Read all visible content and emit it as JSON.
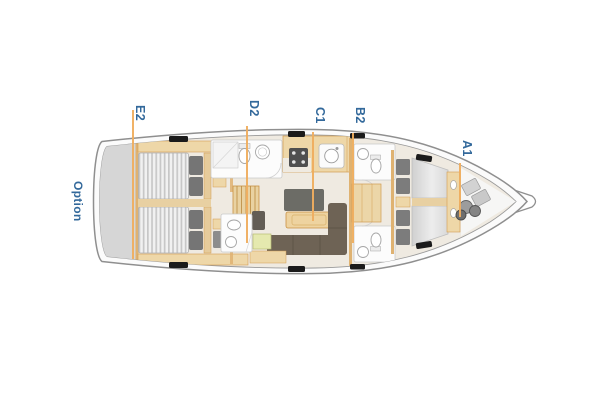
{
  "diagram": {
    "type": "yacht-interior-layout-plan",
    "orientation": "bow-right",
    "annotations": {
      "option": "Option",
      "labels": [
        {
          "code": "E2",
          "area": "aft-cabins"
        },
        {
          "code": "D2",
          "area": "aft-head-galley"
        },
        {
          "code": "C1",
          "area": "salon"
        },
        {
          "code": "B2",
          "area": "forward-heads"
        },
        {
          "code": "A1",
          "area": "forward-cabin"
        }
      ]
    },
    "colors": {
      "label_text": "#33699b",
      "leader_line": "#f0ae5f",
      "hull_outline": "#8f8f8f",
      "deck_fill": "#fbfbfb",
      "floor_fill": "#efeae1",
      "stern_option_area": "#d6d6d6",
      "furniture_tan": "#eed7a8",
      "furniture_tan_border": "#d29c50",
      "sofa_brown": "#6e6355",
      "sideboard_grey": "#6c6c66",
      "mattress_stripe": "#c7c7c7",
      "pillow_grey": "#757575",
      "deck_hatch": "#1b1b1b",
      "nav_table_green": "#e5e9af",
      "fixture_outline": "#a6a6a6"
    }
  }
}
